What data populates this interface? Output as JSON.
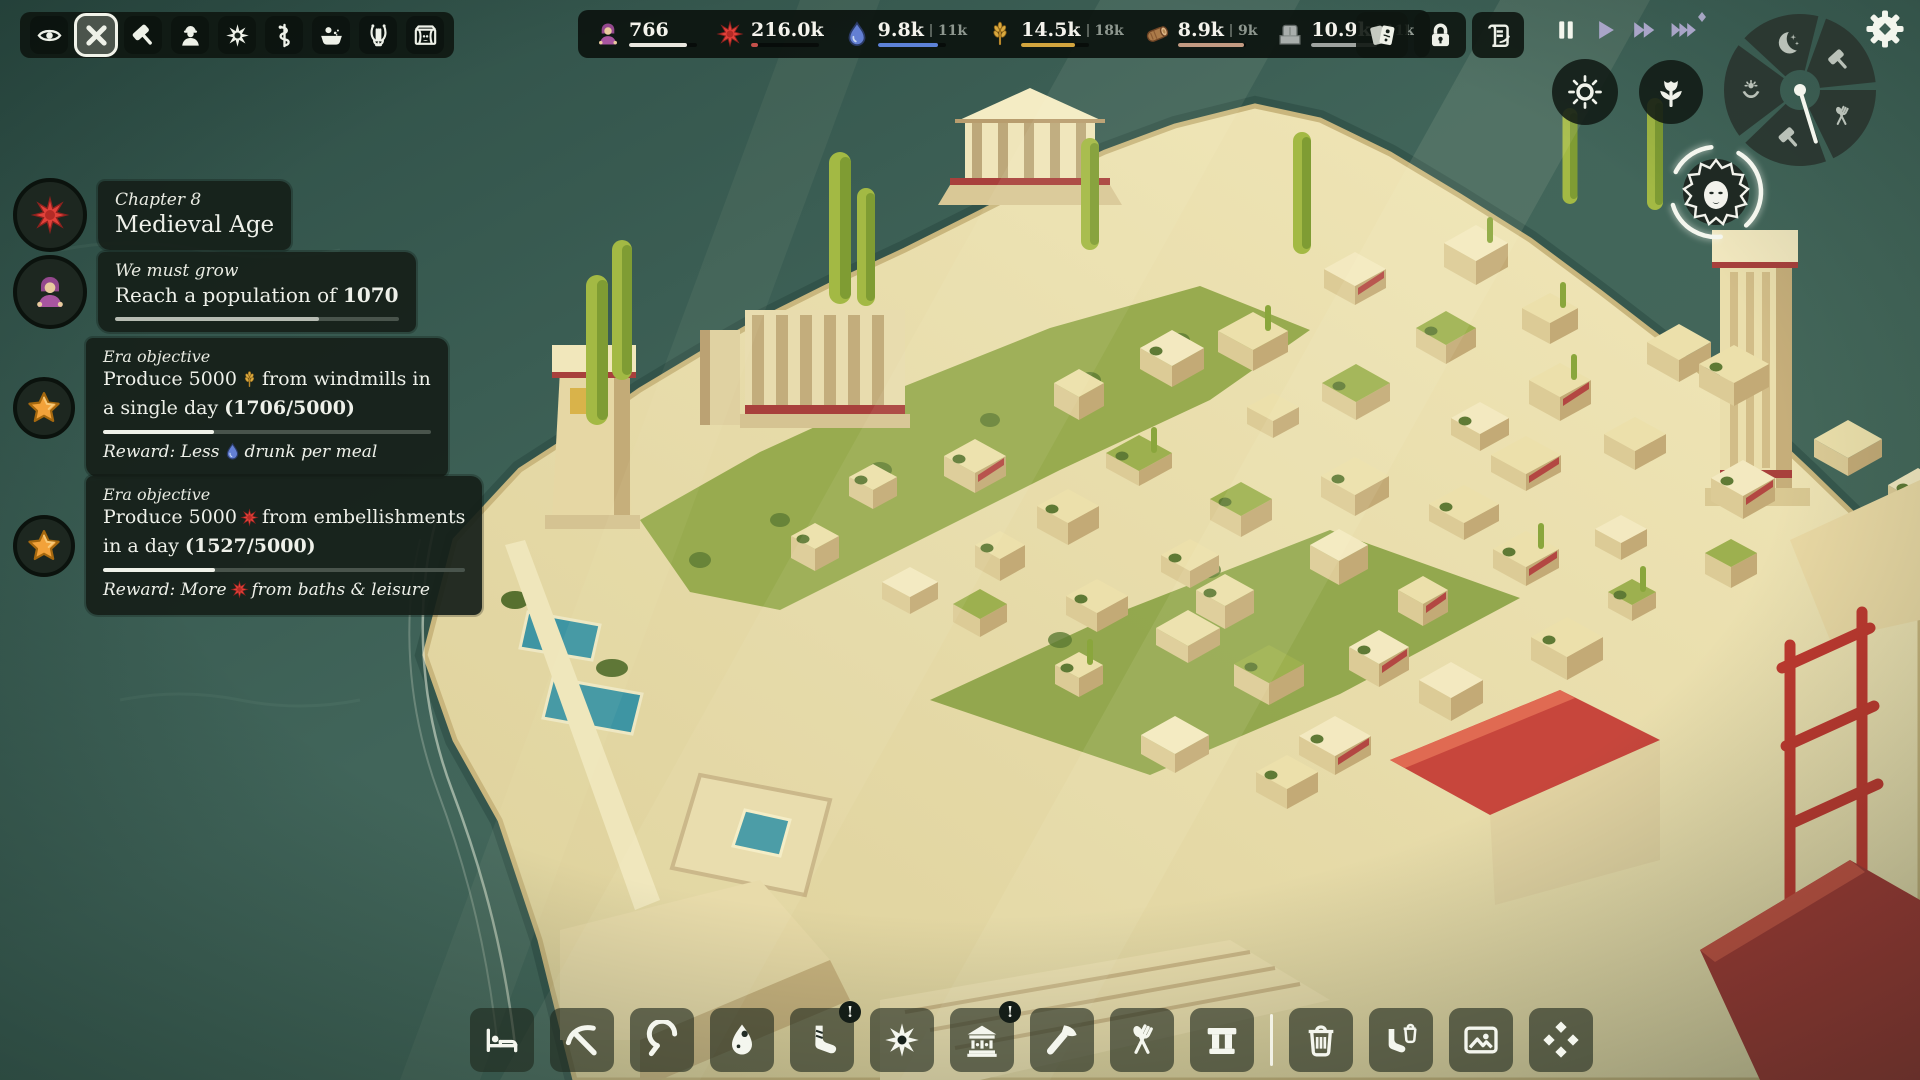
{
  "hud": {
    "left_toolbar": {
      "buttons": [
        {
          "icon": "eye",
          "selected": false
        },
        {
          "icon": "cancel",
          "selected": true
        },
        {
          "icon": "mallet",
          "selected": false
        },
        {
          "icon": "builder",
          "selected": false
        },
        {
          "icon": "spiky-sun",
          "selected": false
        },
        {
          "icon": "snake-staff",
          "selected": false
        },
        {
          "icon": "bath",
          "selected": false
        },
        {
          "icon": "lyre",
          "selected": false
        },
        {
          "icon": "theater",
          "selected": false
        }
      ]
    },
    "resources": [
      {
        "icon": "villager",
        "value": "766",
        "max": "",
        "bar_color": "#e9e7df",
        "bar_fill": 0.85
      },
      {
        "icon": "red-sun",
        "value": "216.0k",
        "max": "",
        "bar_color": "#c4504a",
        "bar_fill": 0.1
      },
      {
        "icon": "water-drop",
        "value": "9.8k",
        "max": "11k",
        "bar_color": "#5d82d8",
        "bar_fill": 0.88
      },
      {
        "icon": "wheat",
        "value": "14.5k",
        "max": "18k",
        "bar_color": "#d3a53e",
        "bar_fill": 0.8
      },
      {
        "icon": "wood-log",
        "value": "8.9k",
        "max": "9k",
        "bar_color": "#c39b82",
        "bar_fill": 0.97
      },
      {
        "icon": "stone",
        "value": "10.9k",
        "max": "11k",
        "bar_color": "#9fa3a0",
        "bar_fill": 0.97
      }
    ],
    "action_buttons": [
      {
        "icon": "cards"
      },
      {
        "icon": "lock"
      },
      {
        "icon": "scroll-quill"
      }
    ],
    "time_controls": [
      {
        "icon": "pause",
        "active": true
      },
      {
        "icon": "play",
        "active": false
      },
      {
        "icon": "fast-forward",
        "active": false
      },
      {
        "icon": "fastest-forward",
        "active": false
      }
    ],
    "settings_button": {
      "icon": "gear"
    },
    "schedule_wheel": {
      "segments": [
        "moon",
        "mallet",
        "cutlery",
        "mallet",
        "worship"
      ],
      "hand_angle_deg": 73
    },
    "ambience_buttons": [
      {
        "icon": "sun"
      },
      {
        "icon": "tulip"
      }
    ],
    "deity_button": {
      "icon": "goddess-face"
    }
  },
  "objectives": {
    "chapter": {
      "icon": "red-sun",
      "kicker": "Chapter 8",
      "title": "Medieval Age"
    },
    "population": {
      "icon": "villager",
      "kicker": "We must grow",
      "text_pre": "Reach a population of ",
      "text_bold": "1070",
      "progress": 0.72
    },
    "era1": {
      "icon": "star",
      "kicker": "Era objective",
      "line1_pre": "Produce 5000",
      "line1_icon": "wheat",
      "line1_post": "from windmills in",
      "line2_pre": "a single day ",
      "line2_bold": "(1706/5000)",
      "progress": 0.34,
      "reward_pre": "Reward: Less",
      "reward_icon": "water-drop",
      "reward_post": "drunk per meal"
    },
    "era2": {
      "icon": "star",
      "kicker": "Era objective",
      "line1_pre": "Produce 5000",
      "line1_icon": "red-sun",
      "line1_post": "from embellishments",
      "line2_pre": "in a day ",
      "line2_bold": "(1527/5000)",
      "progress": 0.31,
      "reward_pre": "Reward: More",
      "reward_icon": "red-sun",
      "reward_post": "from baths & leisure"
    }
  },
  "bottom_toolbar": [
    {
      "icon": "bed",
      "badge": ""
    },
    {
      "icon": "pickaxe",
      "badge": ""
    },
    {
      "icon": "sickle",
      "badge": ""
    },
    {
      "icon": "egg",
      "badge": ""
    },
    {
      "icon": "sandal",
      "badge": "!"
    },
    {
      "icon": "spiky-sun",
      "badge": ""
    },
    {
      "icon": "temple",
      "badge": "!"
    },
    {
      "icon": "hand-axe",
      "badge": ""
    },
    {
      "icon": "cutlery",
      "badge": ""
    },
    {
      "icon": "arch",
      "badge": ""
    },
    {
      "icon": "divider",
      "badge": ""
    },
    {
      "icon": "trash",
      "badge": ""
    },
    {
      "icon": "sandal-trash",
      "badge": ""
    },
    {
      "icon": "picture",
      "badge": ""
    },
    {
      "icon": "diamonds",
      "badge": ""
    }
  ],
  "colors": {
    "accent_red": "#e2413a",
    "water_blue": "#5d82d8",
    "wheat_gold": "#d3a53e",
    "wood_tan": "#c39b82",
    "stone_gray": "#9fa3a0",
    "star_orange": "#f2a23a",
    "time_lavender": "#a9a5c8"
  }
}
